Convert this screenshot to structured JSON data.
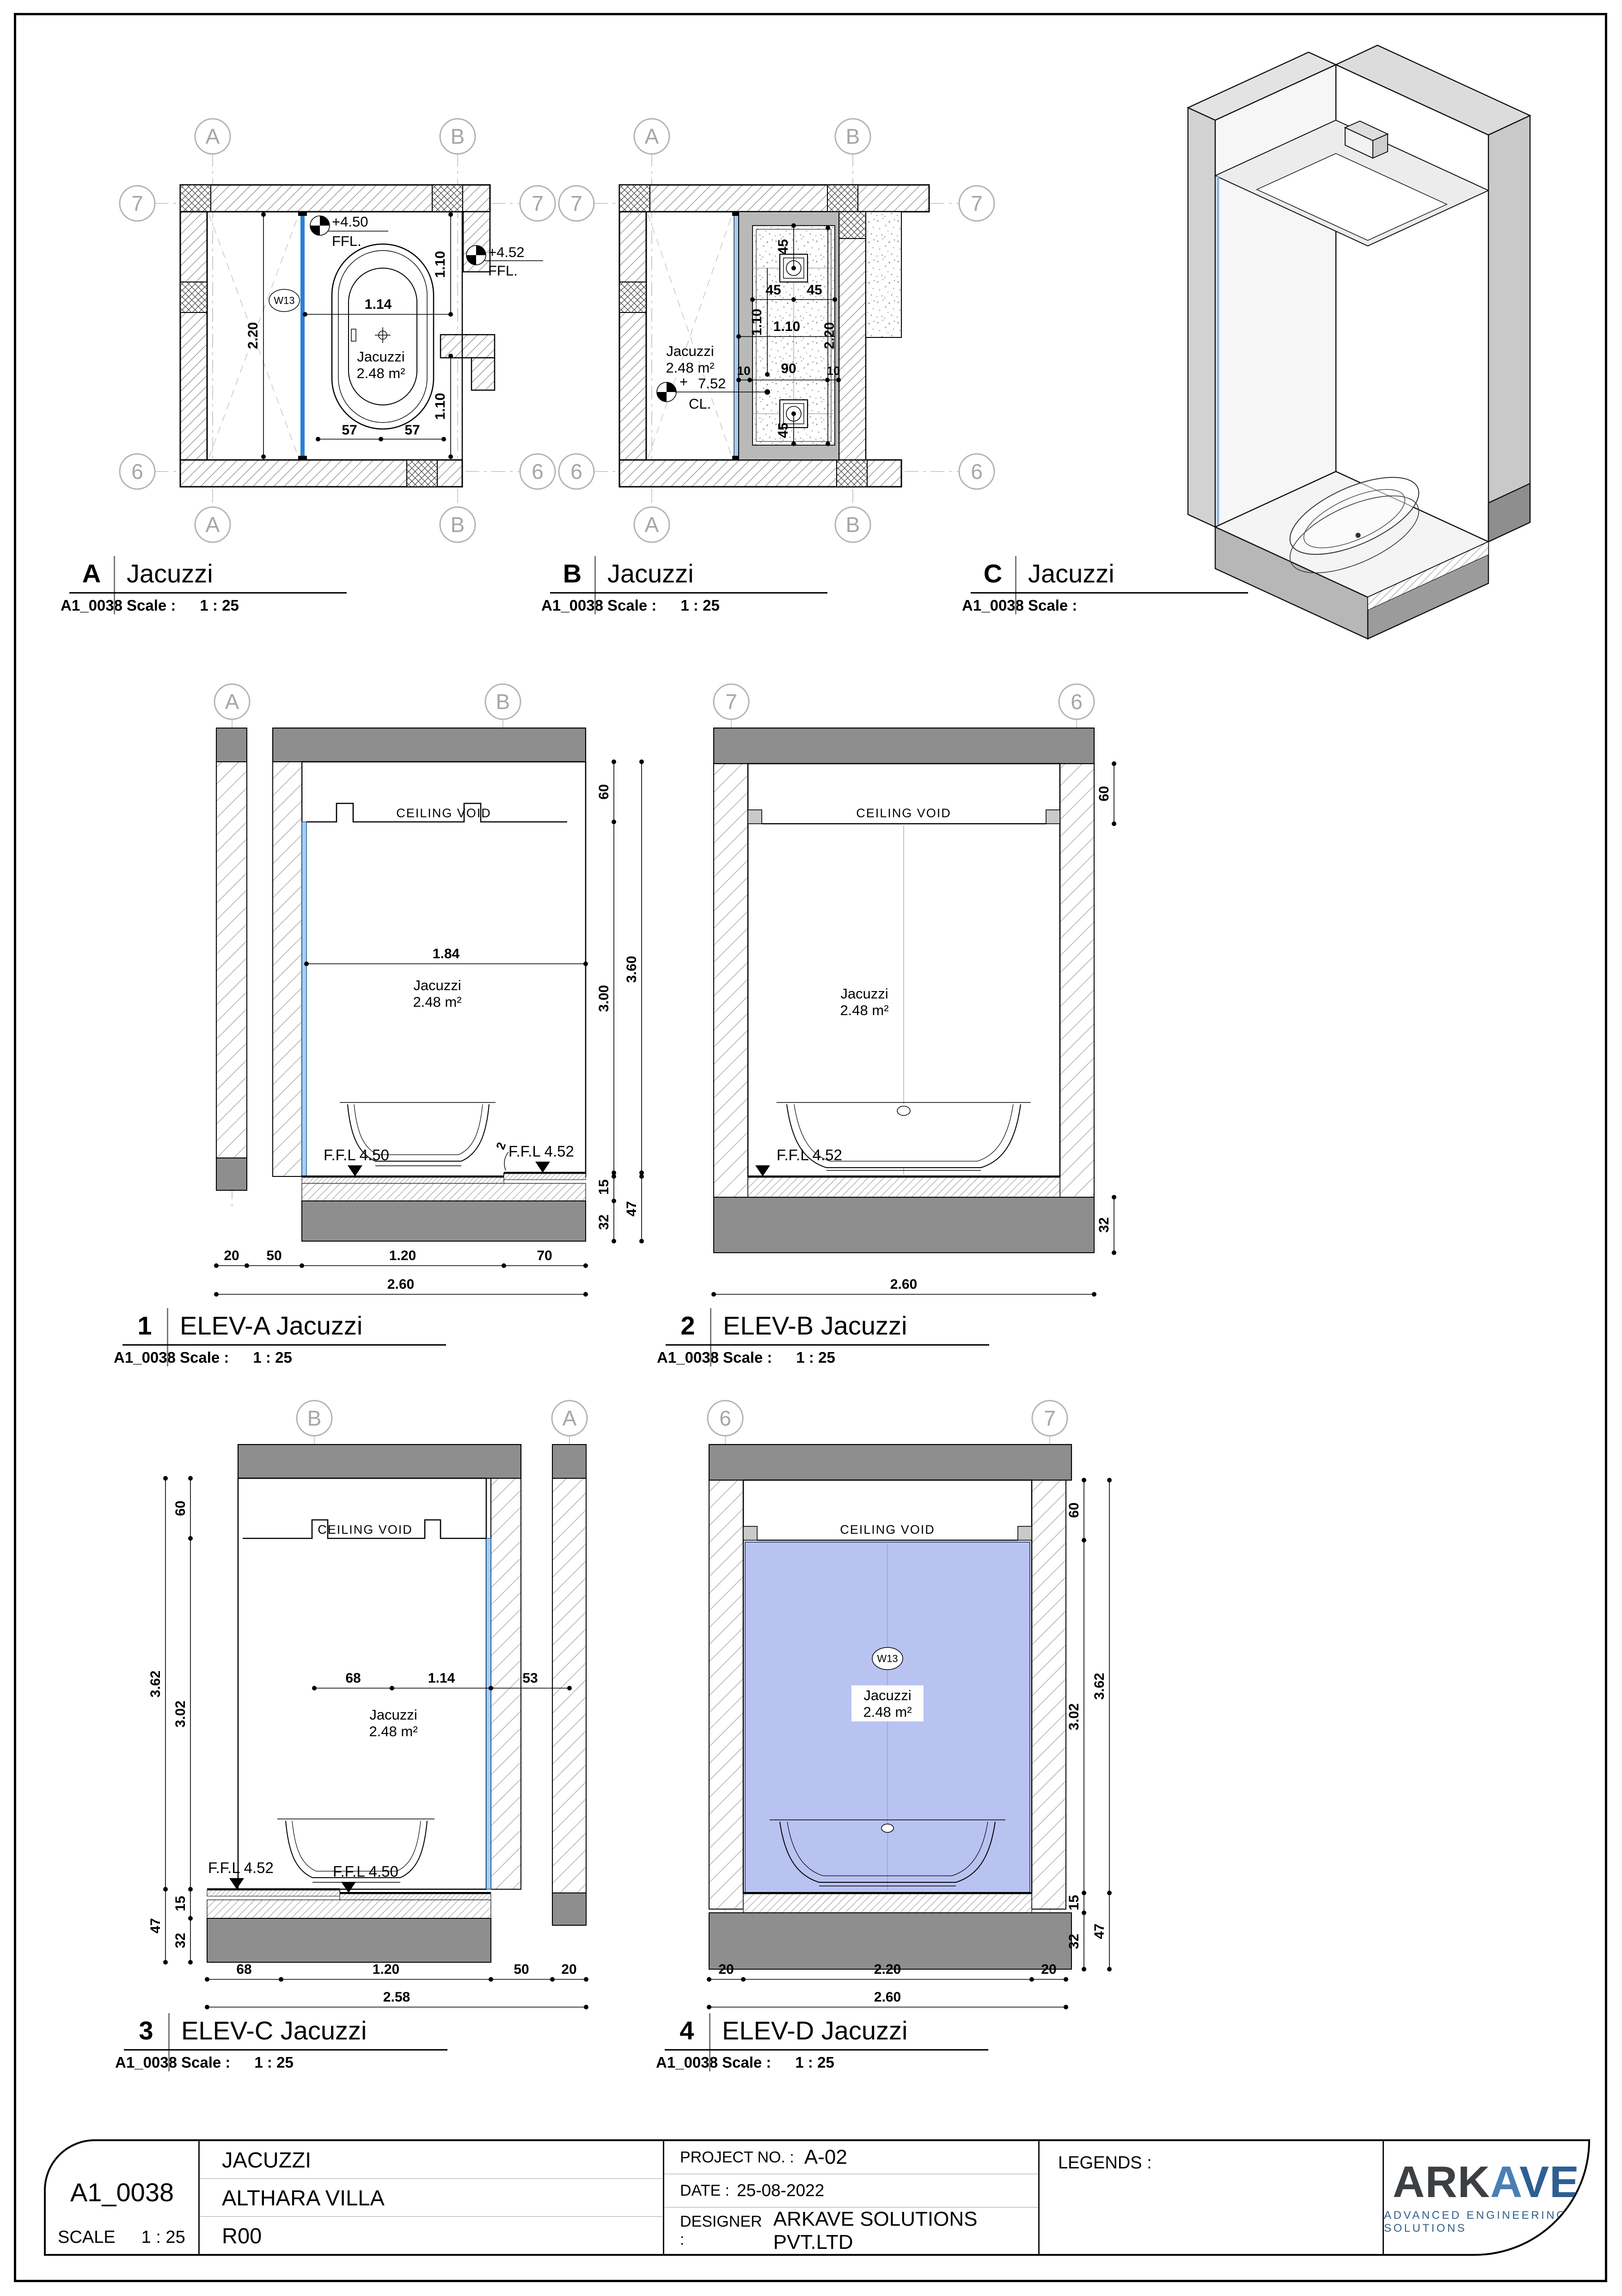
{
  "titleblock": {
    "sheet_no": "A1_0038",
    "scale_label": "SCALE",
    "scale_value": "1 : 25",
    "drawing_title": "JACUZZI",
    "project_name": "ALTHARA VILLA",
    "revision": "R00",
    "project_no_label": "PROJECT NO. :",
    "project_no": "A-02",
    "date_label": "DATE :",
    "date_value": "25-08-2022",
    "designer_label": "DESIGNER :",
    "designer": "ARKAVE SOLUTIONS PVT.LTD",
    "legends_label": "LEGENDS :",
    "logo": {
      "part1": "ARK",
      "part2": "A",
      "part3": "VE",
      "tagline": "ADVANCED ENGINEERING SOLUTIONS"
    }
  },
  "labels": {
    "planA": {
      "key": "A",
      "title": "Jacuzzi",
      "sheet_no": "A1_0038",
      "scale_label": "Scale :",
      "scale_value": "1 : 25"
    },
    "planB": {
      "key": "B",
      "title": "Jacuzzi",
      "sheet_no": "A1_0038",
      "scale_label": "Scale :",
      "scale_value": "1 : 25"
    },
    "viewC": {
      "key": "C",
      "title": "Jacuzzi",
      "sheet_no": "A1_0038",
      "scale_label": "Scale :",
      "scale_value": ""
    },
    "elev1": {
      "key": "1",
      "title": "ELEV-A Jacuzzi",
      "sheet_no": "A1_0038",
      "scale_label": "Scale :",
      "scale_value": "1 : 25"
    },
    "elev2": {
      "key": "2",
      "title": "ELEV-B Jacuzzi",
      "sheet_no": "A1_0038",
      "scale_label": "Scale :",
      "scale_value": "1 : 25"
    },
    "elev3": {
      "key": "3",
      "title": "ELEV-C Jacuzzi",
      "sheet_no": "A1_0038",
      "scale_label": "Scale :",
      "scale_value": "1 : 25"
    },
    "elev4": {
      "key": "4",
      "title": "ELEV-D Jacuzzi",
      "sheet_no": "A1_0038",
      "scale_label": "Scale :",
      "scale_value": "1 : 25"
    }
  },
  "planA": {
    "grid": {
      "top_left": "A",
      "top_right": "B",
      "bottom_left": "A",
      "bottom_right": "B",
      "left_top": "7",
      "left_bottom": "6",
      "right_top": "7",
      "right_bottom": "6"
    },
    "room_name": "Jacuzzi",
    "room_area": "2.48 m²",
    "window_tag": "W13",
    "spot_a_value": "+4.50",
    "spot_a_datum": "FFL.",
    "spot_b_value": "+4.52",
    "spot_b_datum": "FFL.",
    "dim_width": "2.20",
    "dim_tub": "1.14",
    "dim_top": "1.10",
    "dim_bottom": "1.10",
    "dim_57L": "57",
    "dim_57R": "57"
  },
  "planB": {
    "grid": {
      "top_left": "A",
      "top_right": "B",
      "bottom_left": "A",
      "bottom_right": "B",
      "left_top": "7",
      "left_bottom": "6",
      "right_top": "7",
      "right_bottom": "6"
    },
    "room_name": "Jacuzzi",
    "room_area": "2.48 m²",
    "spot_plus": "+",
    "spot_value": "7.52",
    "spot_datum": "CL.",
    "d45_top": "45",
    "d45_l": "45",
    "d45_r": "45",
    "d45_bot": "45",
    "d110_v": "1.10",
    "d220_v": "2.20",
    "d110_h": "1.10",
    "d10_l": "10",
    "d90": "90",
    "d10_r": "10"
  },
  "elev1": {
    "grid_left": "A",
    "grid_right": "B",
    "ceiling_void": "CEILING VOID",
    "room_name": "Jacuzzi",
    "room_area": "2.48 m²",
    "ffl_left": "F.F.L 4.50",
    "ffl_right": "F.F.L 4.52",
    "step_note": "2",
    "d60": "60",
    "d300": "3.00",
    "d360": "3.60",
    "d15": "15",
    "d32": "32",
    "d47": "47",
    "d184": "1.84",
    "b20": "20",
    "b50": "50",
    "b120": "1.20",
    "b70": "70",
    "btotal": "2.60"
  },
  "elev2": {
    "grid_left": "7",
    "grid_right": "6",
    "ceiling_void": "CEILING VOID",
    "room_name": "Jacuzzi",
    "room_area": "2.48 m²",
    "ffl": "F.F.L 4.52",
    "d60": "60",
    "d32": "32",
    "btotal": "2.60"
  },
  "elev3": {
    "grid_left": "B",
    "grid_right": "A",
    "ceiling_void": "CEILING VOID",
    "room_name": "Jacuzzi",
    "room_area": "2.48 m²",
    "ffl_left": "F.F.L 4.52",
    "ffl_right": "F.F.L 4.50",
    "d60": "60",
    "d362": "3.62",
    "d302": "3.02",
    "d15": "15",
    "d32": "32",
    "d47": "47",
    "m68": "68",
    "m114": "1.14",
    "m53": "53",
    "b68": "68",
    "b120": "1.20",
    "b50": "50",
    "b20": "20",
    "btotal": "2.58"
  },
  "elev4": {
    "grid_left": "6",
    "grid_right": "7",
    "ceiling_void": "CEILING VOID",
    "room_name": "Jacuzzi",
    "room_area": "2.48 m²",
    "window_tag": "W13",
    "d60": "60",
    "d362": "3.62",
    "d302": "3.02",
    "d15": "15",
    "d32": "32",
    "d47": "47",
    "b20l": "20",
    "b220": "2.20",
    "b20r": "20",
    "btotal": "2.60"
  }
}
